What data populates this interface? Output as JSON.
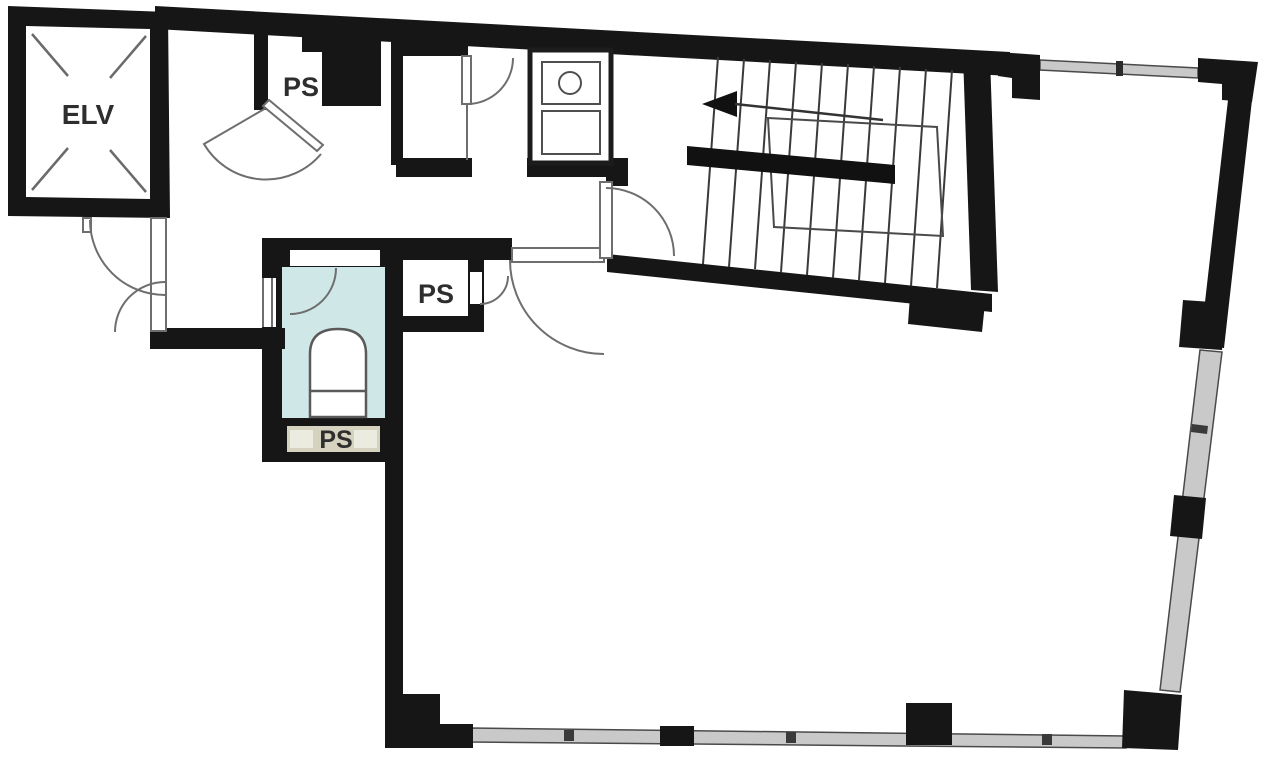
{
  "floorplan": {
    "type": "building-floor-plan",
    "labels": {
      "elevator": "ELV",
      "pipe_shaft_top": "PS",
      "pipe_shaft_middle": "PS",
      "pipe_shaft_bottom": "PS"
    },
    "colors": {
      "wall": "#161616",
      "background": "#ffffff",
      "toilet_room_fill": "#cfe7e6",
      "ps_strip_fill": "#d6d2c0",
      "ps_strip_panel": "#ecebe0",
      "window_fill": "#c9c9c9",
      "door_line": "#6e6e6e"
    }
  }
}
